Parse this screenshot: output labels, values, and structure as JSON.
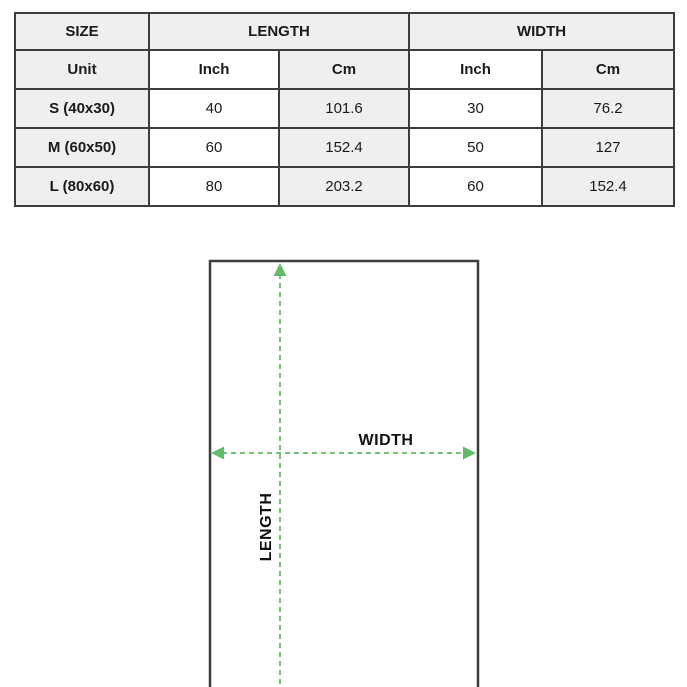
{
  "colors": {
    "accent-green": "#63ba69",
    "border-dark": "#3d3d3d",
    "header-bg": "#efefef",
    "cell-white": "#ffffff",
    "text-dark": "#1a1a1a",
    "page-bg": "#ffffff"
  },
  "table": {
    "header": {
      "size": "SIZE",
      "length": "LENGTH",
      "width": "WIDTH"
    },
    "subheader": {
      "unit": "Unit",
      "length_inch": "Inch",
      "length_cm": "Cm",
      "width_inch": "Inch",
      "width_cm": "Cm"
    },
    "rows": [
      {
        "size": "S (40x30)",
        "length_inch": "40",
        "length_cm": "101.6",
        "width_inch": "30",
        "width_cm": "76.2"
      },
      {
        "size": "M (60x50)",
        "length_inch": "60",
        "length_cm": "152.4",
        "width_inch": "50",
        "width_cm": "127"
      },
      {
        "size": "L (80x60)",
        "length_inch": "80",
        "length_cm": "203.2",
        "width_inch": "60",
        "width_cm": "152.4"
      }
    ]
  },
  "chart_data": {
    "type": "table",
    "title": "Blanket size chart",
    "columns": [
      "SIZE",
      "LENGTH Inch",
      "LENGTH Cm",
      "WIDTH Inch",
      "WIDTH Cm"
    ],
    "rows": [
      [
        "S (40x30)",
        40,
        101.6,
        30,
        76.2
      ],
      [
        "M (60x50)",
        60,
        152.4,
        50,
        127
      ],
      [
        "L (80x60)",
        80,
        203.2,
        60,
        152.4
      ]
    ]
  },
  "diagram": {
    "width_label": "WIDTH",
    "length_label": "LENGTH"
  }
}
